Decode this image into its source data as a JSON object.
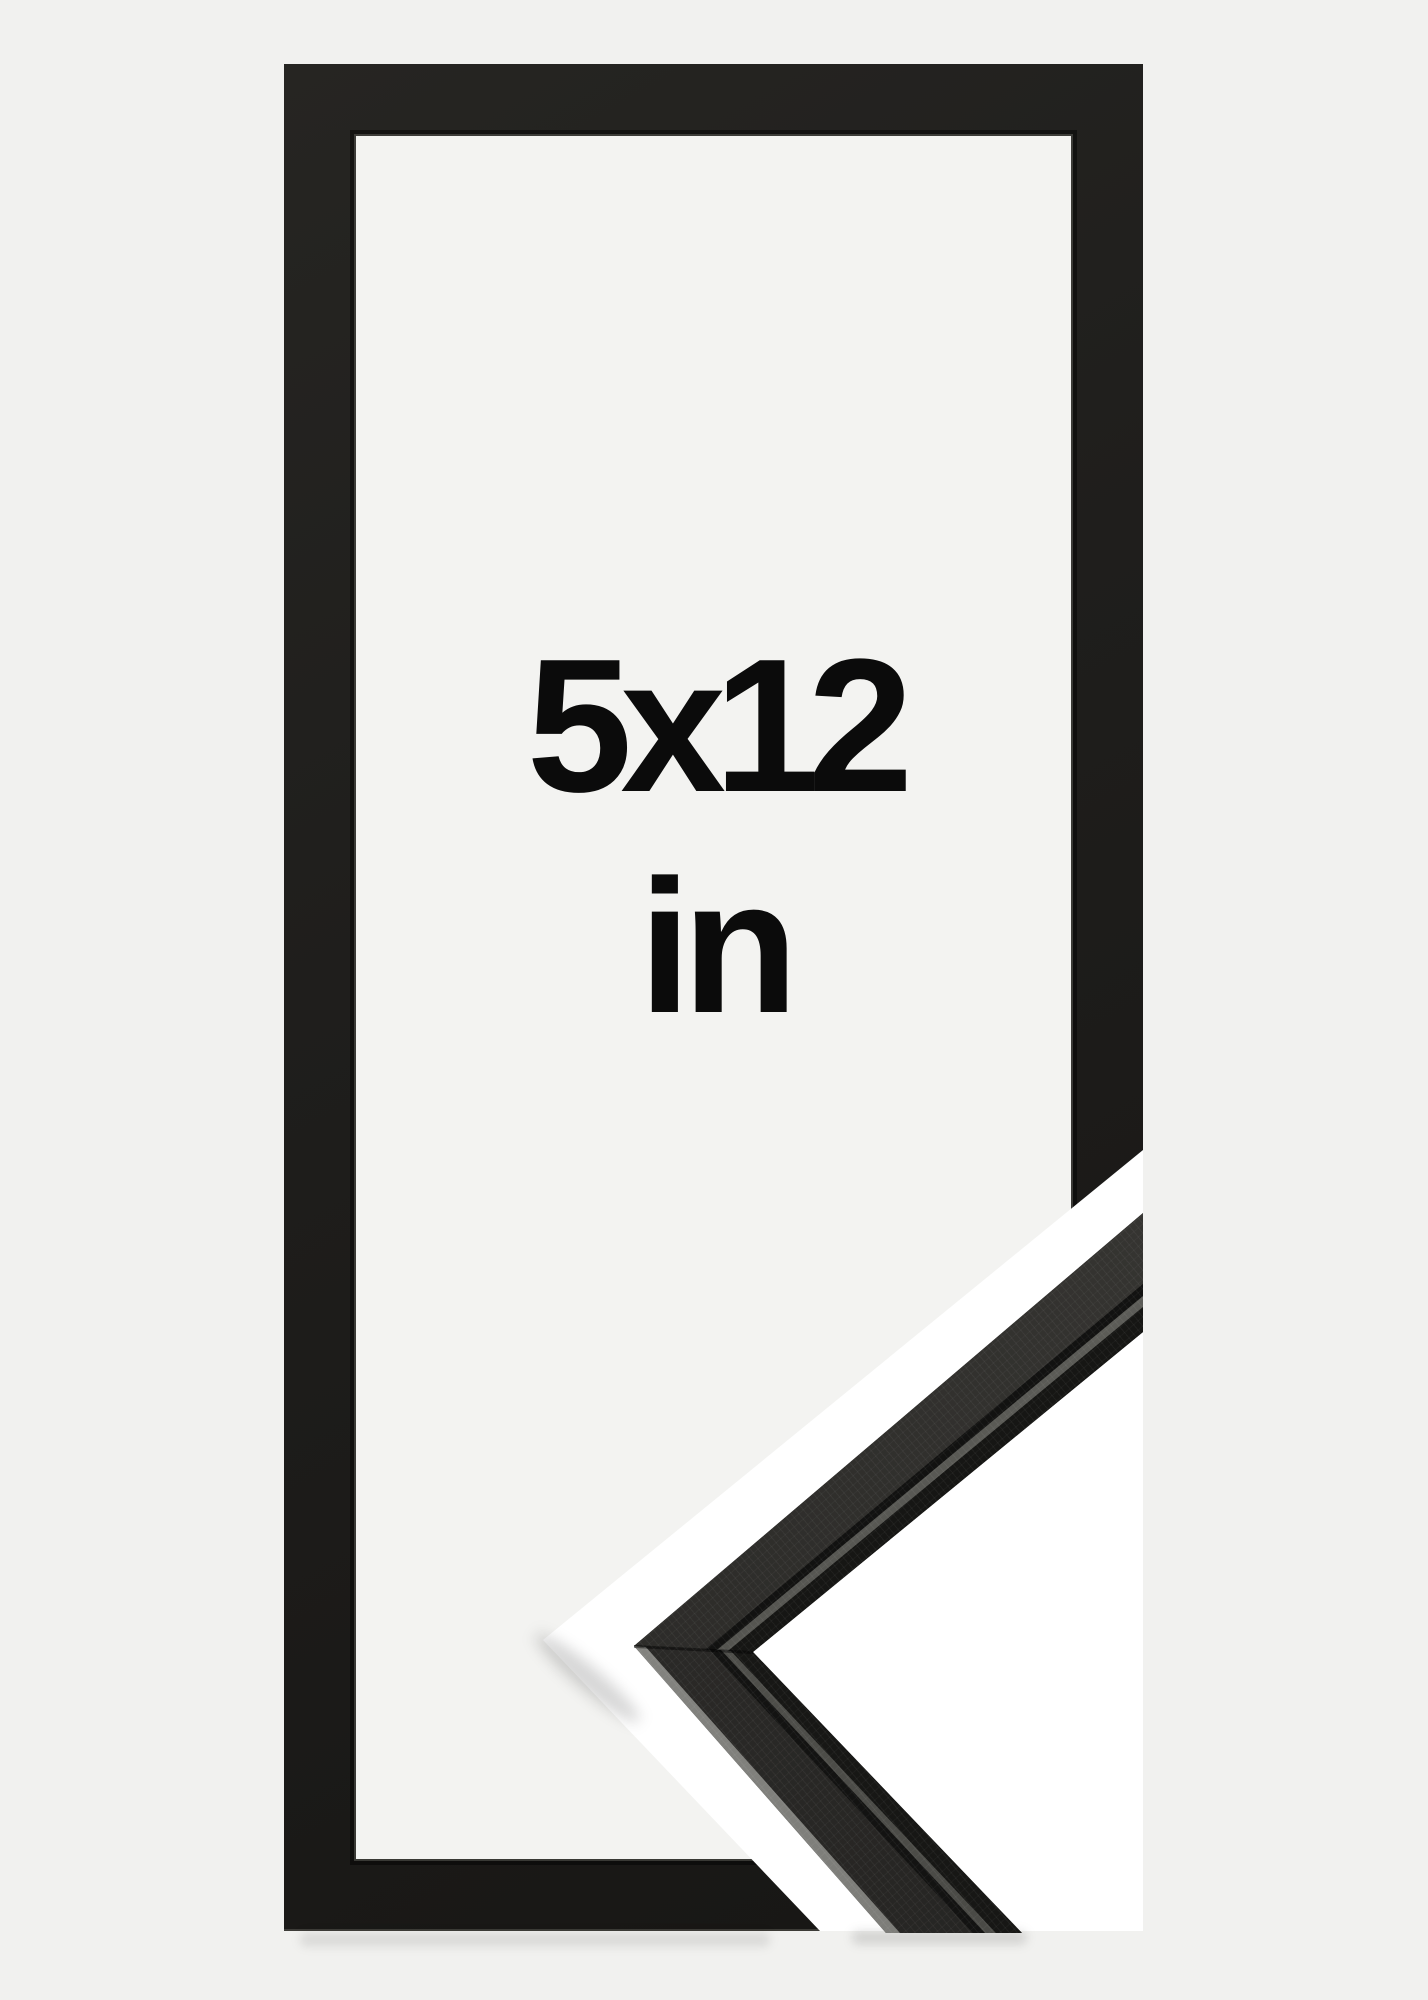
{
  "product": {
    "size_label": "5x12",
    "unit_label": "in"
  },
  "palette": {
    "page_background": "#f1f1ef",
    "frame_color": "#1d1c1a",
    "frame_opening_background": "#f3f3f1",
    "cut_band_color": "#ffffff",
    "label_color": "#0b0b0b",
    "sample_face_color": "#32312e",
    "sample_bevel_color": "#93938f",
    "sample_lip_color": "#5e5e5a",
    "sample_rebate_wall_color": "#161614"
  }
}
